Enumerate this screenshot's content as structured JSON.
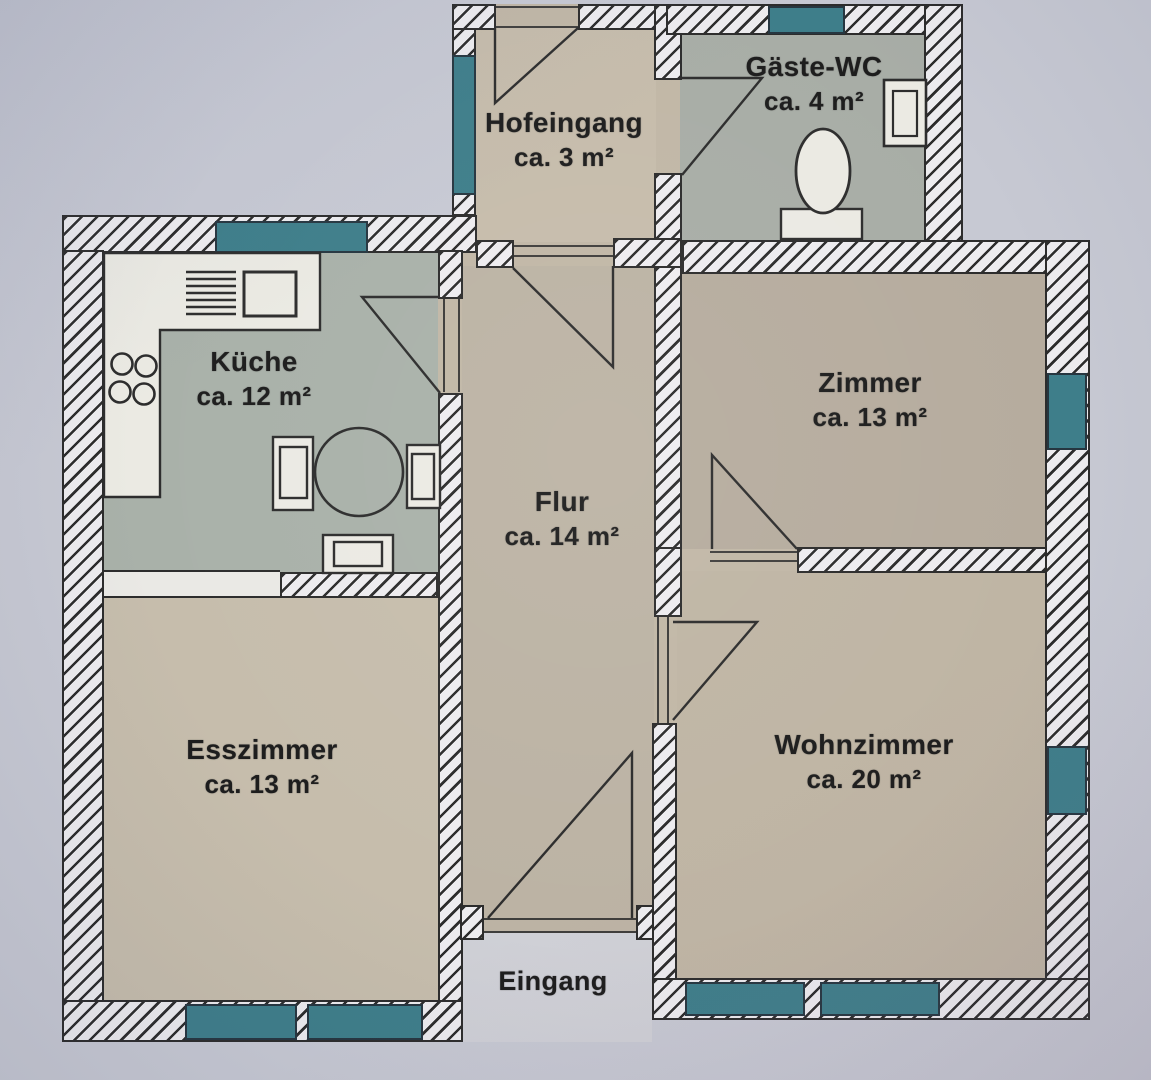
{
  "colors": {
    "background": "#c7c9d3",
    "wall_fill": "#edecef",
    "wall_line": "#2c2c2c",
    "window_teal": "#3e7e8a",
    "floor_beige": "#c1b7a6",
    "floor_green_kitchen": "#a9b1a9",
    "floor_green_wc": "#a8ada6",
    "fixture_fill": "#ebeae3",
    "porch": "#cfd0d6",
    "label_color": "#1d1d1d"
  },
  "rooms": {
    "hofeingang": {
      "name": "Hofeingang",
      "area": "ca. 3 m²"
    },
    "gaeste_wc": {
      "name": "Gäste-WC",
      "area": "ca. 4 m²"
    },
    "kueche": {
      "name": "Küche",
      "area": "ca. 12 m²"
    },
    "zimmer": {
      "name": "Zimmer",
      "area": "ca. 13 m²"
    },
    "flur": {
      "name": "Flur",
      "area": "ca. 14 m²"
    },
    "esszimmer": {
      "name": "Esszimmer",
      "area": "ca. 13 m²"
    },
    "wohnzimmer": {
      "name": "Wohnzimmer",
      "area": "ca. 20 m²"
    }
  },
  "labels": {
    "entrance": "Eingang"
  },
  "fixtures": [
    "toilet",
    "wash-basin",
    "stove",
    "kitchen-sink",
    "cooktop-burners",
    "dining-table",
    "chair",
    "counter"
  ]
}
